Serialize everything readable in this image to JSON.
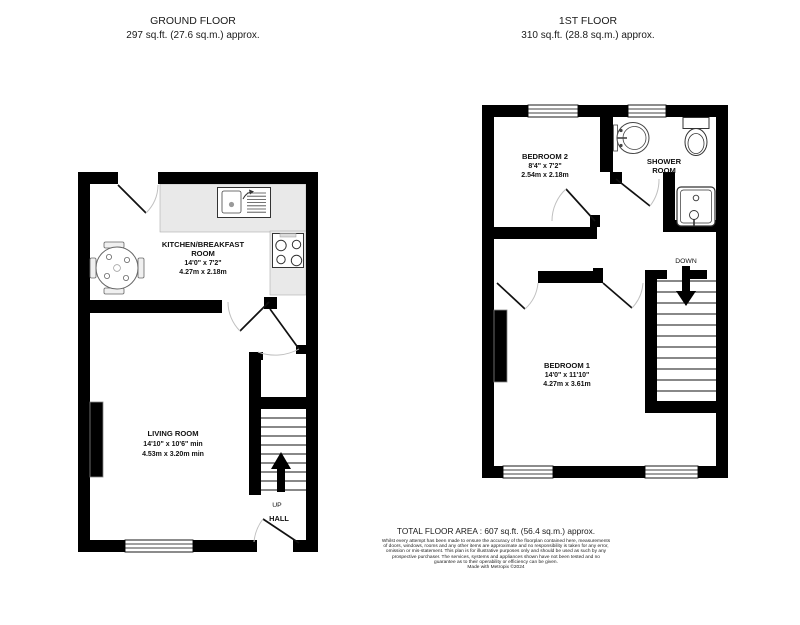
{
  "ground_floor": {
    "title": "GROUND FLOOR",
    "area": "297 sq.ft. (27.6 sq.m.) approx.",
    "kitchen": {
      "name_line1": "KITCHEN/BREAKFAST",
      "name_line2": "ROOM",
      "dims_imperial": "14'0\" x 7'2\"",
      "dims_metric": "4.27m x 2.18m"
    },
    "living_room": {
      "name": "LIVING ROOM",
      "dims_imperial": "14'10\" x 10'6\" min",
      "dims_metric": "4.53m x 3.20m min"
    },
    "hall": {
      "name": "HALL"
    },
    "stairs": {
      "label": "UP"
    }
  },
  "first_floor": {
    "title": "1ST FLOOR",
    "area": "310 sq.ft. (28.8 sq.m.) approx.",
    "bedroom2": {
      "name": "BEDROOM 2",
      "dims_imperial": "8'4\" x 7'2\"",
      "dims_metric": "2.54m x 2.18m"
    },
    "shower_room": {
      "name_line1": "SHOWER",
      "name_line2": "ROOM"
    },
    "bedroom1": {
      "name": "BEDROOM 1",
      "dims_imperial": "14'0\" x 11'10\"",
      "dims_metric": "4.27m x 3.61m"
    },
    "stairs": {
      "label": "DOWN"
    }
  },
  "footer": {
    "total_area": "TOTAL FLOOR AREA : 607 sq.ft. (56.4 sq.m.) approx.",
    "disclaimer": "Whilst every attempt has been made to ensure the accuracy of the floorplan contained here, measurements of doors, windows, rooms and any other items are approximate and no responsibility is taken for any error, omission or mis-statement. This plan is for illustrative purposes only and should be used as such by any prospective purchaser. The services, systems and appliances shown have not been tested and no guarantee as to their operability or efficiency can be given.",
    "credit": "Made with Metropix ©2024"
  },
  "colors": {
    "wall": "#000000",
    "counter": "#e9e9e9",
    "background": "#ffffff"
  }
}
